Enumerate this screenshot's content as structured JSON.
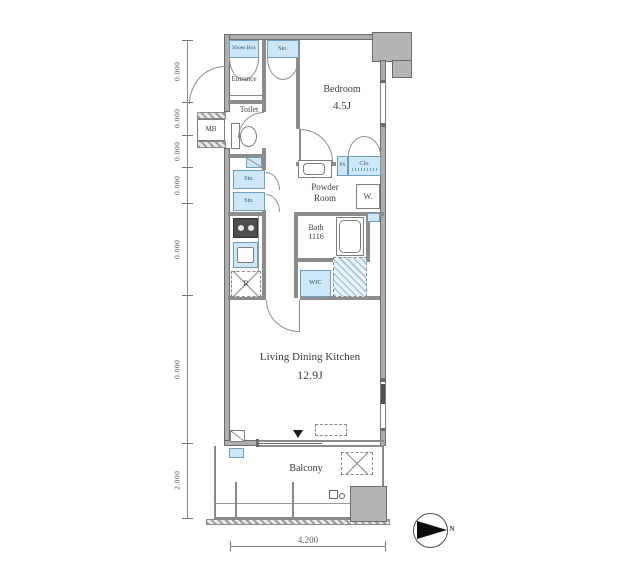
{
  "plan": {
    "entrance": "Entrance",
    "shoes_box": "Shoes Box",
    "sto_top": "Sto.",
    "toilet": "Toilet",
    "mb": "MB",
    "bedroom_name": "Bedroom",
    "bedroom_size": "4.5J",
    "clo": "Clo.",
    "ps": "PS",
    "powder_line1": "Powder",
    "powder_line2": "Room",
    "washer": "W.",
    "bath_name": "Bath",
    "bath_size": "1116",
    "sto_1": "Sto.",
    "sto_2": "Sto.",
    "fridge": "R",
    "wic": "WIC",
    "ldk_name": "Living Dining Kitchen",
    "ldk_size": "12.9J",
    "balcony": "Balcony"
  },
  "dimensions": {
    "left_labels": [
      "0.000",
      "0.000",
      "0.000",
      "0.000",
      "0.000",
      "0.000",
      "2.000"
    ],
    "bottom_width": "4.200"
  },
  "compass": {
    "label": "N"
  },
  "colors": {
    "fixture_blue": "#cde7f6",
    "wall_gray": "#8c8c8c",
    "text": "#3c3c3c"
  }
}
